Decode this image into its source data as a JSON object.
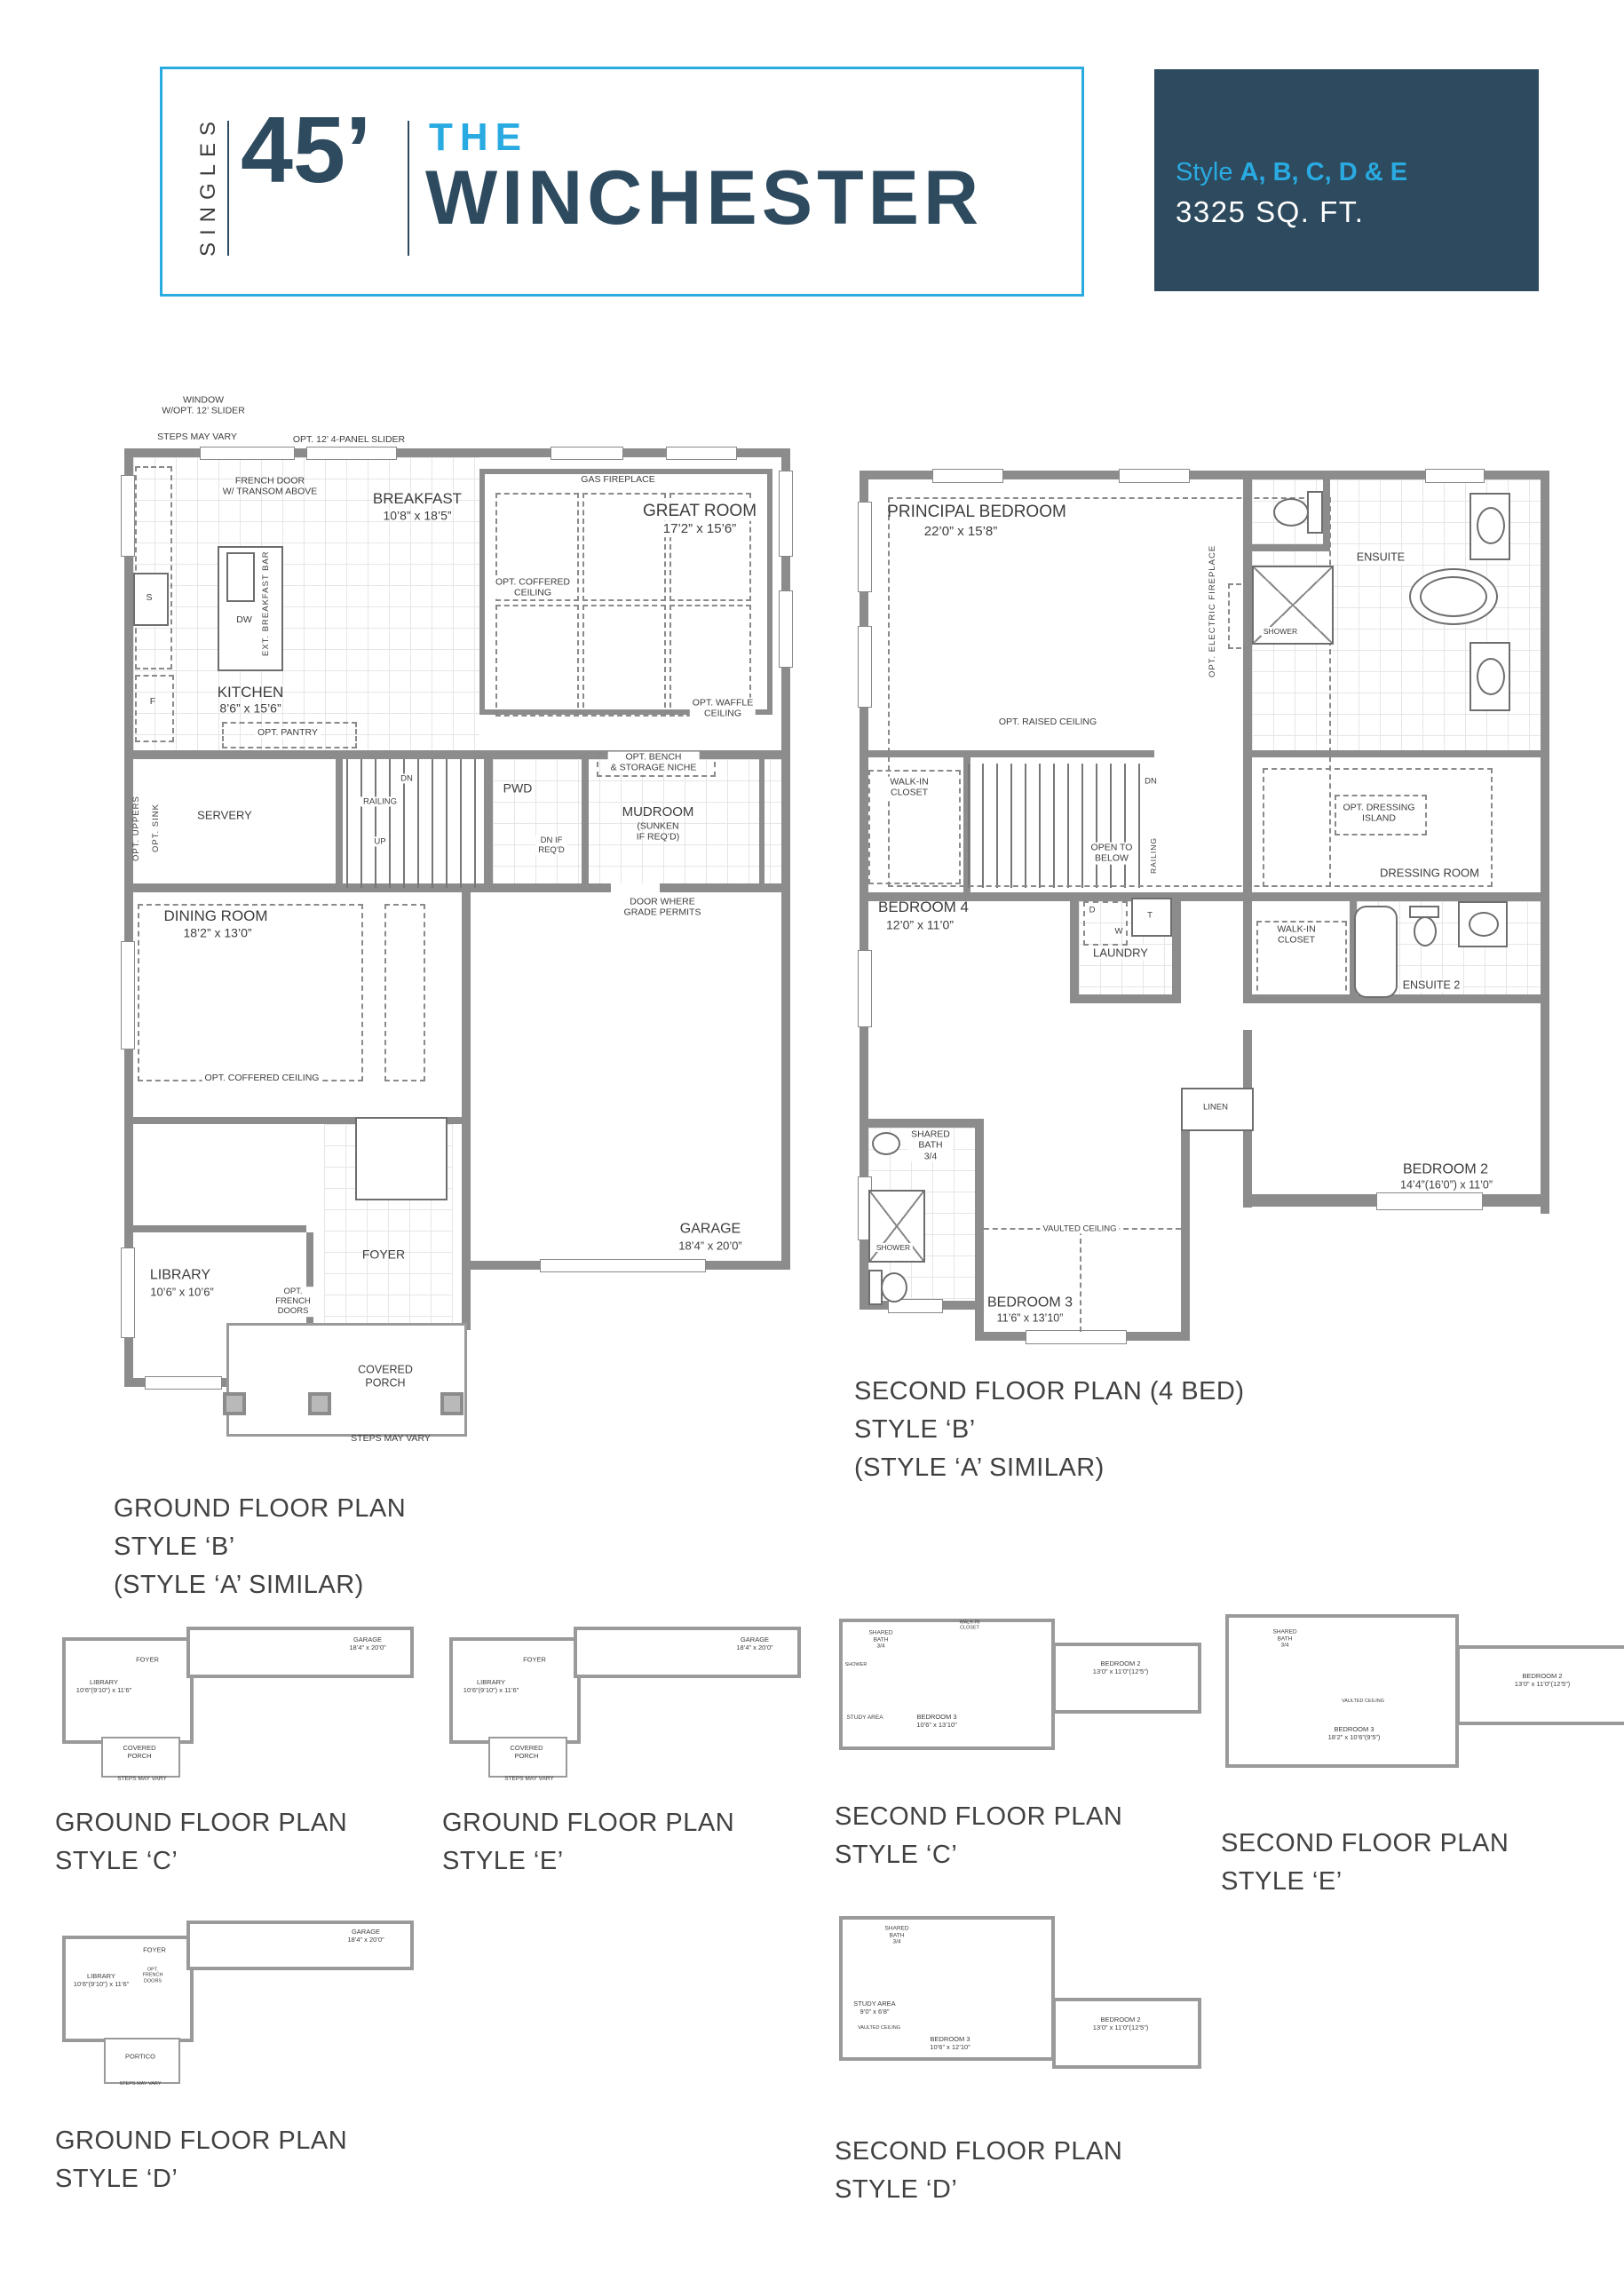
{
  "colors": {
    "accent_blue": "#29abe2",
    "navy": "#2d4a5e",
    "wall_gray": "#8c8c8c"
  },
  "header": {
    "series": "SINGLES",
    "width": "45’",
    "the": "THE",
    "name": "WINCHESTER",
    "style_label": "Style",
    "style_letters": "A, B, C, D & E",
    "sqft": "3325 SQ. FT."
  },
  "ground_b": {
    "caption": [
      "GROUND FLOOR PLAN",
      "STYLE ‘B’",
      "(STYLE ‘A’ SIMILAR)"
    ],
    "labels": {
      "window_slider": "WINDOW\nW/OPT. 12’ SLIDER",
      "steps_top": "STEPS MAY VARY",
      "panel_slider": "OPT. 12’ 4-PANEL SLIDER",
      "french_door": "FRENCH DOOR\nW/ TRANSOM ABOVE",
      "breakfast": "BREAKFAST",
      "breakfast_dims": "10’8” x 18’5”",
      "gas_fireplace": "GAS FIREPLACE",
      "great_room": "GREAT ROOM",
      "great_room_dims": "17’2” x 15’6”",
      "coffered_ceiling": "OPT. COFFERED\nCEILING",
      "waffle_ceiling": "OPT. WAFFLE\nCEILING",
      "kitchen": "KITCHEN",
      "kitchen_dims": "8’6” x 15’6”",
      "dw": "DW",
      "ext_breakfast_bar": "EXT. BREAKFAST BAR",
      "fridge": "F",
      "cooktop": "S",
      "opt_pantry": "OPT. PANTRY",
      "opt_uppers": "OPT. UPPERS",
      "opt_sink": "OPT. SINK",
      "servery": "SERVERY",
      "dn": "DN",
      "up": "UP",
      "railing": "RAILING",
      "pwd": "PWD",
      "dn_if_reqd": "DN IF\nREQ’D",
      "bench": "OPT. BENCH\n& STORAGE NICHE",
      "mudroom": "MUDROOM",
      "mudroom_sub": "(SUNKEN\nIF REQ’D)",
      "door_grade": "DOOR WHERE\nGRADE PERMITS",
      "dining": "DINING ROOM",
      "dining_dims": "18’2” x 13’0”",
      "coffered_dining": "OPT. COFFERED CEILING",
      "library": "LIBRARY",
      "library_dims": "10’6” x 10’6”",
      "french_doors": "OPT.\nFRENCH\nDOORS",
      "foyer": "FOYER",
      "porch": "COVERED\nPORCH",
      "steps_bottom": "STEPS MAY VARY",
      "garage": "GARAGE",
      "garage_dims": "18’4” x 20’0”"
    }
  },
  "second_b": {
    "caption": [
      "SECOND FLOOR PLAN (4 BED)",
      "STYLE ‘B’",
      "(STYLE ‘A’ SIMILAR)"
    ],
    "labels": {
      "principal": "PRINCIPAL BEDROOM",
      "principal_dims": "22’0” x 15’8”",
      "raised": "OPT. RAISED CEILING",
      "elec_fireplace": "OPT. ELECTRIC FIREPLACE",
      "ensuite": "ENSUITE",
      "shower": "SHOWER",
      "wic": "WALK-IN\nCLOSET",
      "dn": "DN",
      "open_below": "OPEN TO\nBELOW",
      "railing": "RAILING",
      "bedroom4": "BEDROOM 4",
      "bedroom4_dims": "12’0” x 11’0”",
      "laundry": "LAUNDRY",
      "d": "D",
      "w": "W",
      "t": "T",
      "dressing_island": "OPT. DRESSING\nISLAND",
      "dressing_room": "DRESSING ROOM",
      "wic2": "WALK-IN\nCLOSET",
      "ensuite2": "ENSUITE 2",
      "linen": "LINEN",
      "bedroom2": "BEDROOM 2",
      "bedroom2_dims": "14’4”(16’0”) x 11’0”",
      "shared_bath": "SHARED\nBATH\n3/4",
      "shower2": "SHOWER",
      "vaulted": "VAULTED CEILING",
      "bedroom3": "BEDROOM 3",
      "bedroom3_dims": "11’6” x 13’10”"
    }
  },
  "thumbs": {
    "gc": {
      "caption": [
        "GROUND FLOOR PLAN",
        "STYLE ‘C’"
      ],
      "labels": {
        "garage": "GARAGE\n18’4” x 20’0”",
        "library": "LIBRARY\n10’6”(9’10”) x 11’6”",
        "foyer": "FOYER",
        "porch": "COVERED\nPORCH",
        "steps": "STEPS MAY VARY"
      }
    },
    "ge": {
      "caption": [
        "GROUND FLOOR PLAN",
        "STYLE ‘E’"
      ],
      "labels": {
        "garage": "GARAGE\n18’4” x 20’0”",
        "library": "LIBRARY\n10’6”(9’10”) x 11’6”",
        "foyer": "FOYER",
        "porch": "COVERED\nPORCH",
        "steps": "STEPS MAY VARY"
      }
    },
    "sc": {
      "caption": [
        "SECOND FLOOR PLAN",
        "STYLE ‘C’"
      ],
      "labels": {
        "shared_bath": "SHARED\nBATH\n3/4",
        "shower": "SHOWER",
        "study": "STUDY AREA",
        "bedroom3": "BEDROOM 3\n10’6” x 13’10”",
        "wic": "WALK-IN\nCLOSET",
        "bedroom2": "BEDROOM 2\n13’0” x 11’0”(12’5”)"
      }
    },
    "se": {
      "caption": [
        "SECOND FLOOR PLAN",
        "STYLE ‘E’"
      ],
      "labels": {
        "shared_bath": "SHARED\nBATH\n3/4",
        "vaulted": "VAULTED CEILING",
        "bedroom3": "BEDROOM 3\n18’2” x 10’6”(9’5”)",
        "bedroom2": "BEDROOM 2\n13’0” x 11’0”(12’5”)"
      }
    },
    "gd": {
      "caption": [
        "GROUND FLOOR PLAN",
        "STYLE ‘D’"
      ],
      "labels": {
        "garage": "GARAGE\n18’4” x 20’0”",
        "library": "LIBRARY\n10’6”(9’10”) x 11’6”",
        "french_doors": "OPT.\nFRENCH\nDOORS",
        "foyer": "FOYER",
        "portico": "PORTICO",
        "steps": "STEPS MAY VARY"
      }
    },
    "sd": {
      "caption": [
        "SECOND FLOOR PLAN",
        "STYLE ‘D’"
      ],
      "labels": {
        "study": "STUDY AREA\n9’0” x 6’8”",
        "shared_bath": "SHARED\nBATH\n3/4",
        "vaulted": "VAULTED CEILING",
        "bedroom3": "BEDROOM 3\n10’6” x 12’10”",
        "bedroom2": "BEDROOM 2\n13’0” x 11’0”(12’5”)"
      }
    }
  }
}
